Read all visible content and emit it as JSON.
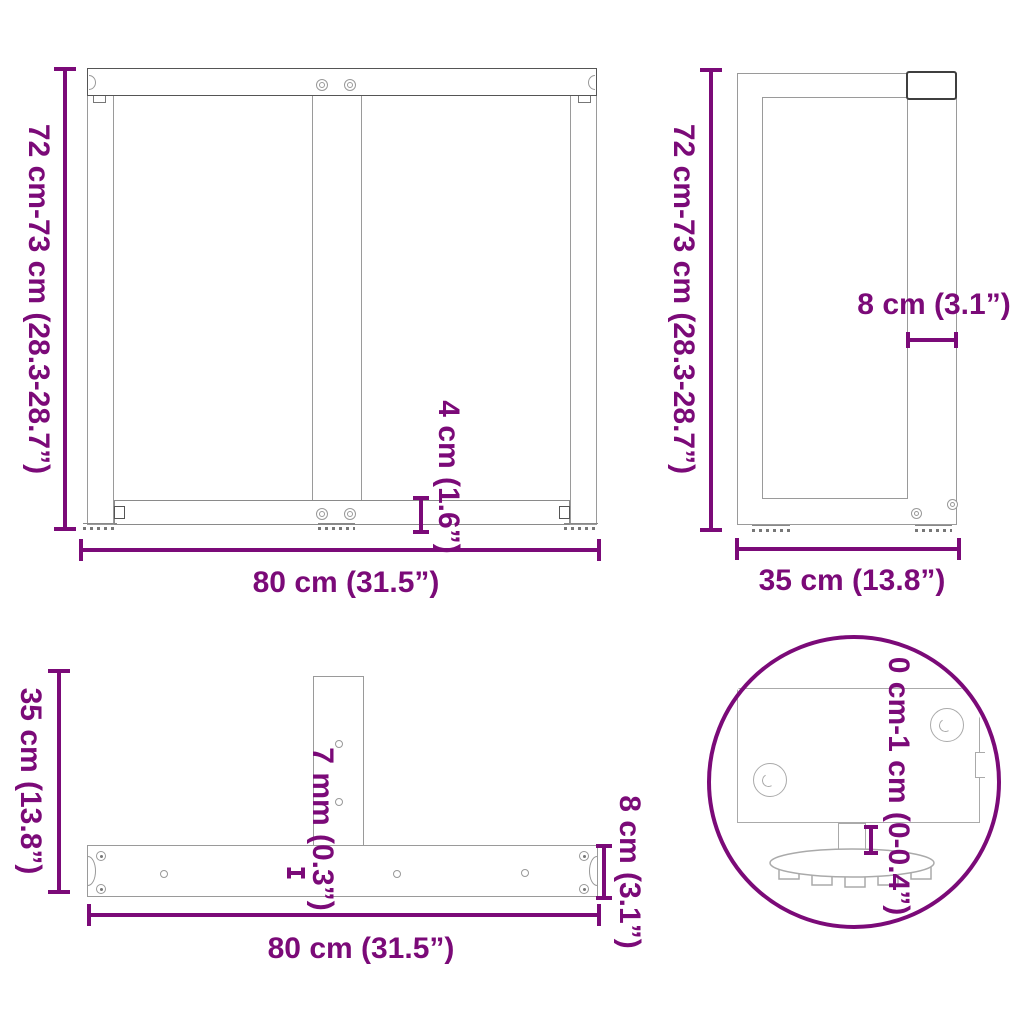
{
  "colors": {
    "accent": "#7B0A78",
    "drawing_line": "#9a9a9a",
    "drawing_line_dark": "#3f3f3f"
  },
  "views": {
    "front": {
      "height_label": "72 cm-73 cm (28.3-28.7”)",
      "width_label": "80 cm (31.5”)",
      "rail_height_label": "4 cm (1.6”)"
    },
    "side": {
      "height_label": "72 cm-73 cm (28.3-28.7”)",
      "depth_label": "35 cm (13.8”)",
      "column_width_label": "8 cm (3.1”)"
    },
    "plan": {
      "depth_label": "35 cm (13.8”)",
      "width_label": "80 cm (31.5”)",
      "plate_thickness_label": "7 mm (0.3”)",
      "bar_width_label": "8 cm (3.1”)"
    },
    "detail": {
      "adjust_range_label": "0 cm-1 cm (0-0.4”)"
    }
  }
}
